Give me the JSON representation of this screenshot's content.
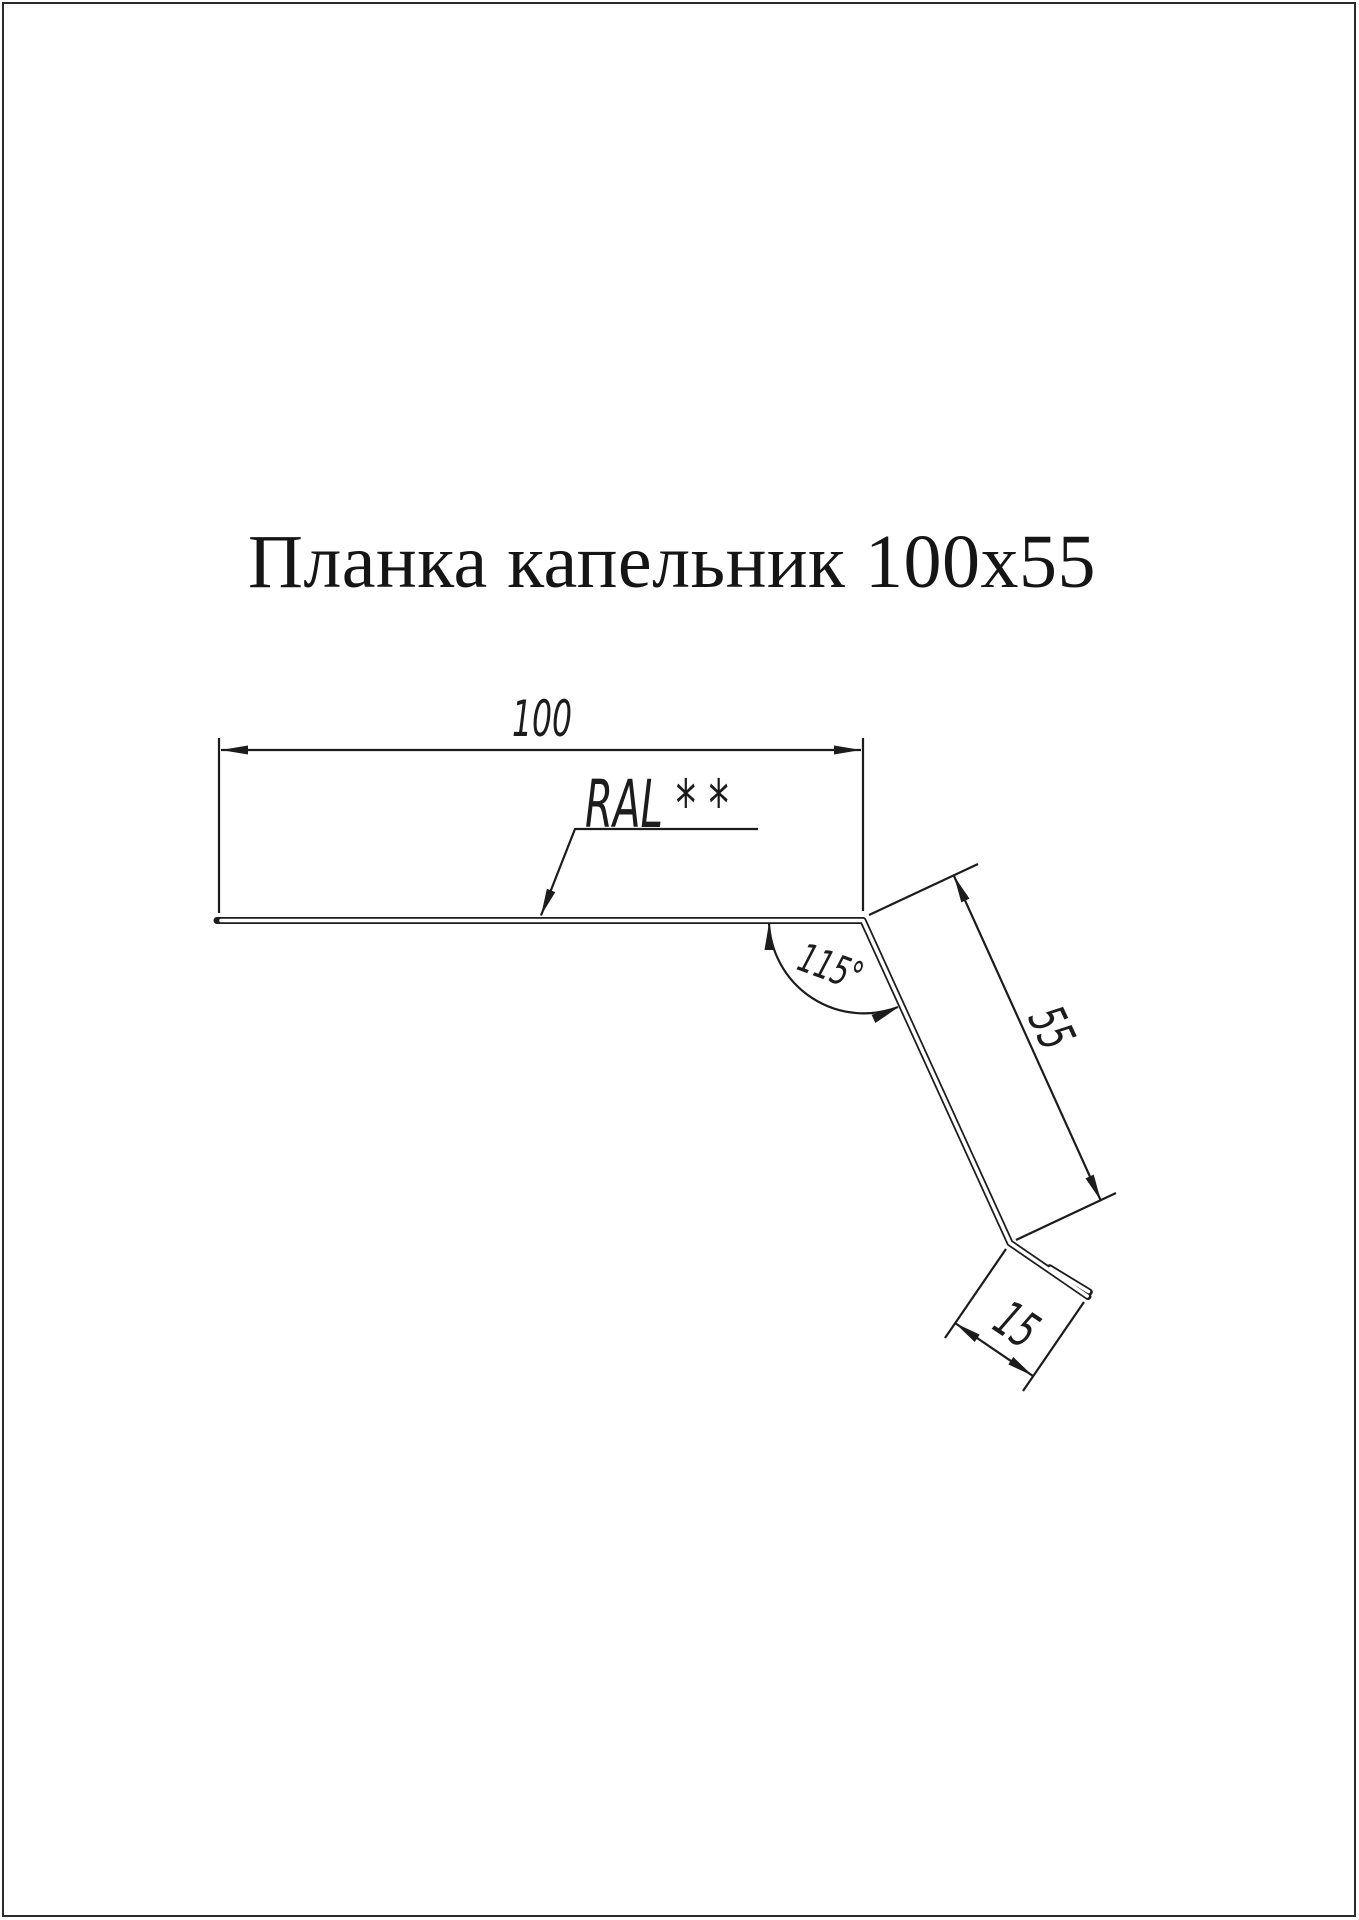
{
  "page": {
    "background": "#ffffff",
    "border_color": "#2b2b2b",
    "line_color": "#1c1c1c"
  },
  "title": "Планка капельник 100х55",
  "drawing": {
    "product": "Планка капельник",
    "labels": {
      "width": "100",
      "slope": "55",
      "hook": "15",
      "angle": "115°",
      "color_note": "RAL * *"
    }
  }
}
